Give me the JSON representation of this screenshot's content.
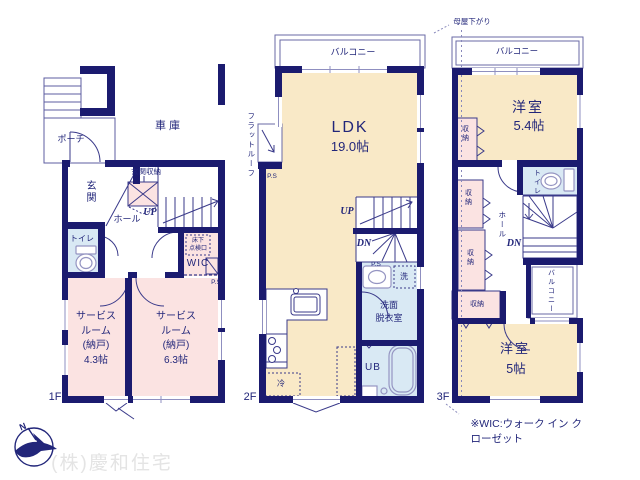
{
  "colors": {
    "wall": "#1b1b6f",
    "room_tatami": "#f9e9c7",
    "room_service": "#fbe3e2",
    "room_wet": "#d9e9f4",
    "line": "#3a3a8a",
    "watermark_gray": "#e4e4e4"
  },
  "floor1": {
    "label": "1F",
    "porch": "ポーチ",
    "garage": "車庫",
    "entrance": "玄関",
    "entrance_storage": "玄関収納",
    "hall": "ホール",
    "up": "UP",
    "toilet": "トイレ",
    "underfloor_hatch": "床下\n点検口",
    "wic": "WIC",
    "ps": "P.S",
    "service_room_a": "サービス\nルーム\n(納戸)\n4.3帖",
    "service_room_b": "サービス\nルーム\n(納戸)\n6.3帖"
  },
  "floor2": {
    "label": "2F",
    "balcony": "バルコニー",
    "flat_roof": "フラットルーフ",
    "ps_left": "P.S",
    "ldk_name": "LDK",
    "ldk_size": "19.0帖",
    "up": "UP",
    "dn": "DN",
    "ps": "P.S",
    "laundry": "洗",
    "washroom": "洗面\n脱衣室",
    "unit_bath": "UB",
    "fridge": "冷"
  },
  "floor3": {
    "label": "3F",
    "dropped_roof": "母屋下がり",
    "balcony_top": "バルコニー",
    "room_a_name": "洋室",
    "room_a_size": "5.4帖",
    "closet1": "収納",
    "closet2": "収納",
    "closet3": "収納",
    "closet4": "収納",
    "toilet": "トイレ",
    "hall": "ホール",
    "dn": "DN",
    "balcony_side": "バルコニー",
    "room_b_name": "洋室",
    "room_b_size": "5帖"
  },
  "notes": {
    "wic_note": "※WIC:ウォーク イン クローゼット",
    "compass_n": "N"
  },
  "watermark": "(株)慶和住宅"
}
